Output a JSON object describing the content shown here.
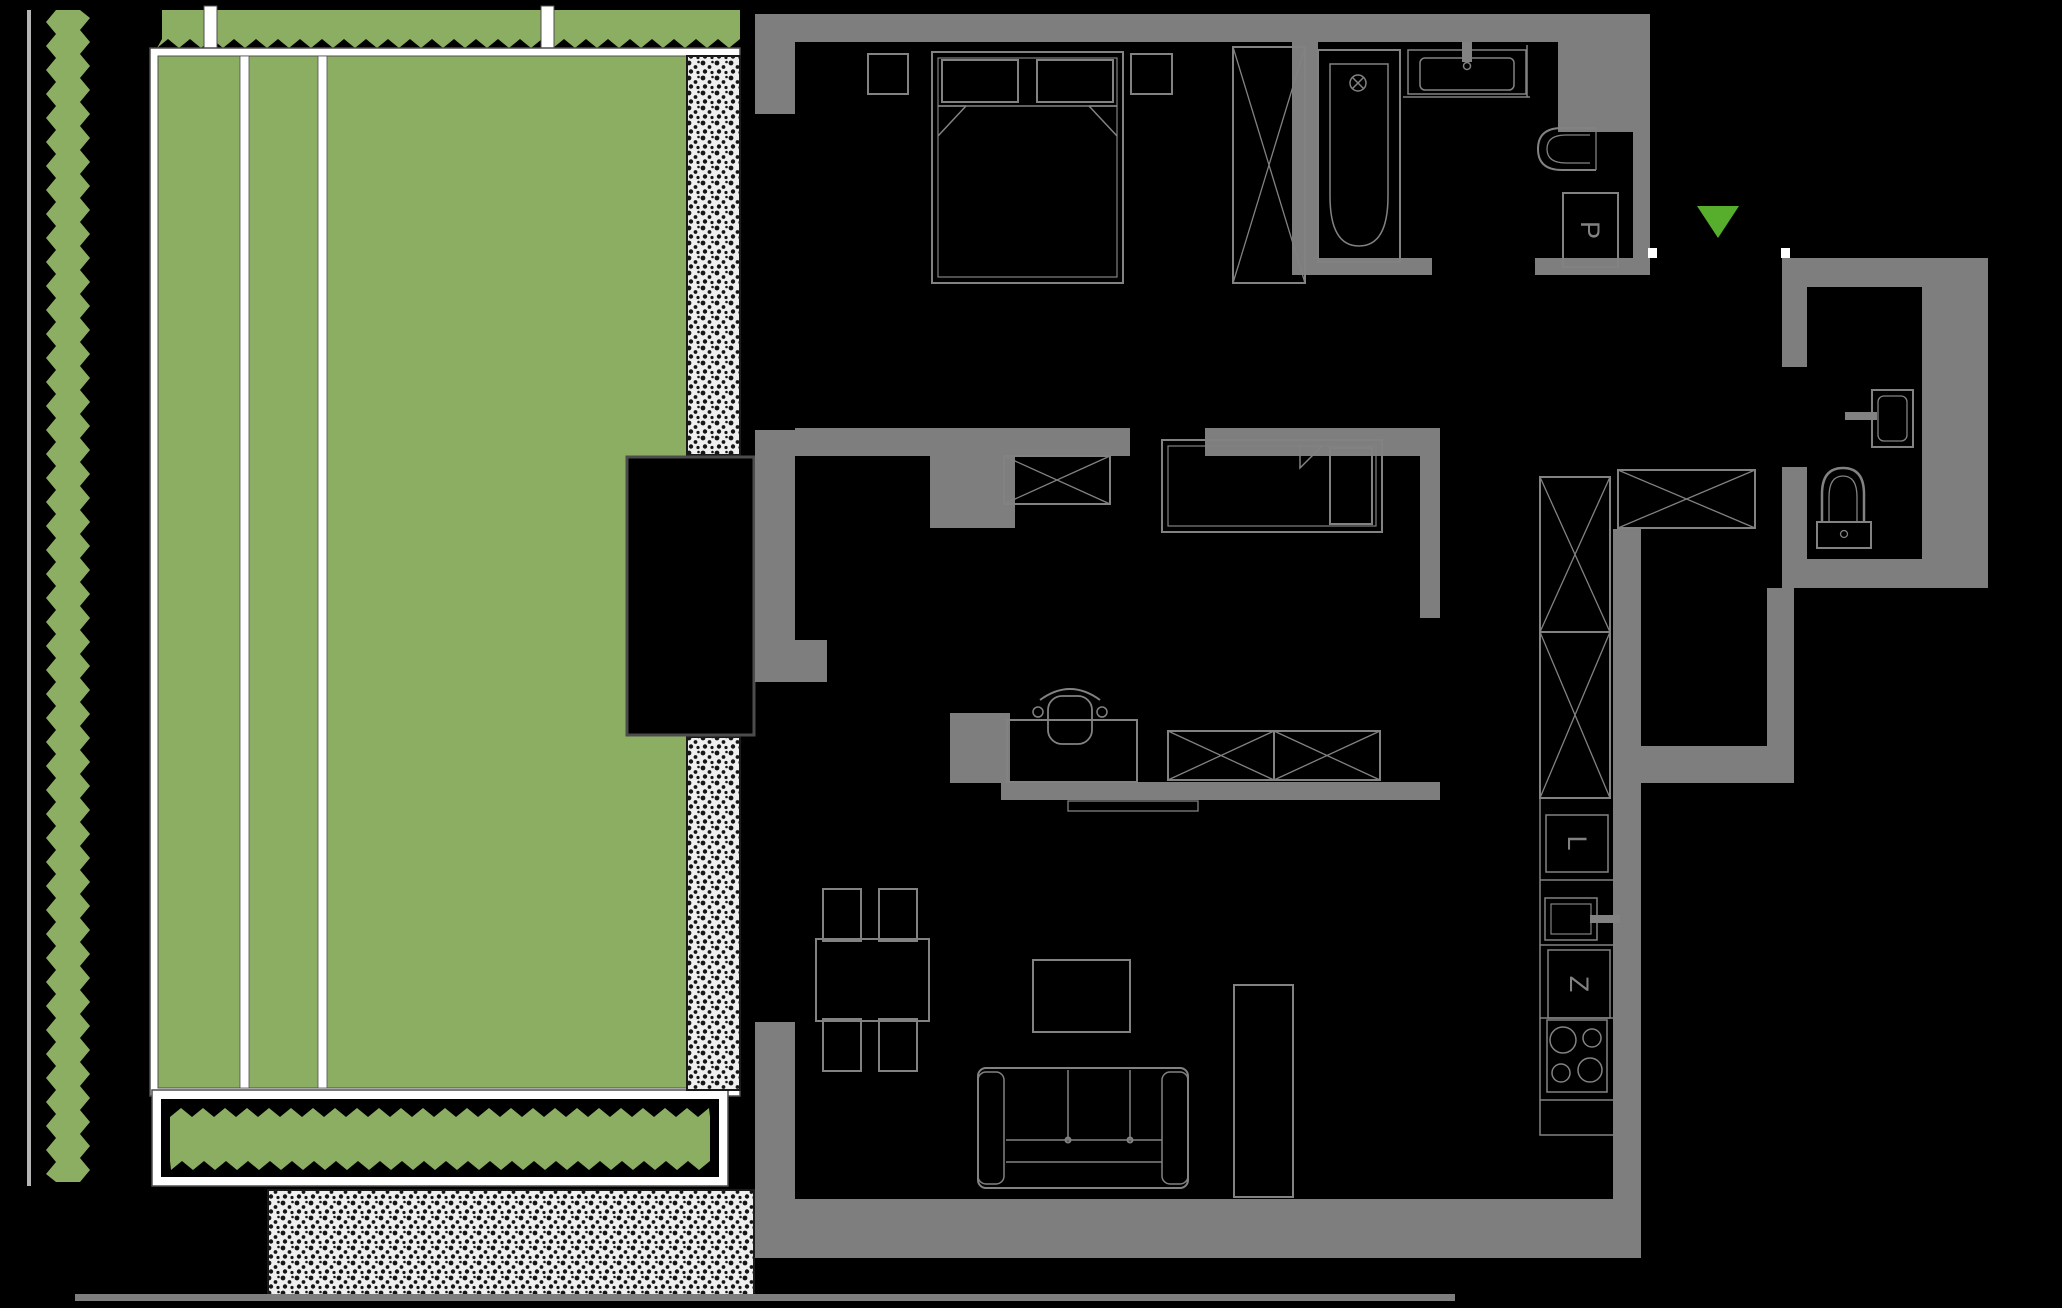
{
  "title": "apartment floor plan with garden",
  "appliances": {
    "washing_machine_label": "P",
    "fridge_label": "L",
    "dishwasher_label": "Z"
  },
  "entrance_marker": "down-arrow",
  "palette": {
    "background": "#000000",
    "wall": "#7e7e7e",
    "lawn": "#8cae63",
    "hedge": "#8cae63",
    "frame_white": "#ffffff",
    "paving_bg": "#efefef",
    "paving_dot": "#161616",
    "furniture_line": "#828282",
    "hairline": "#4f4f4f",
    "entrance": "#56ae2c"
  }
}
